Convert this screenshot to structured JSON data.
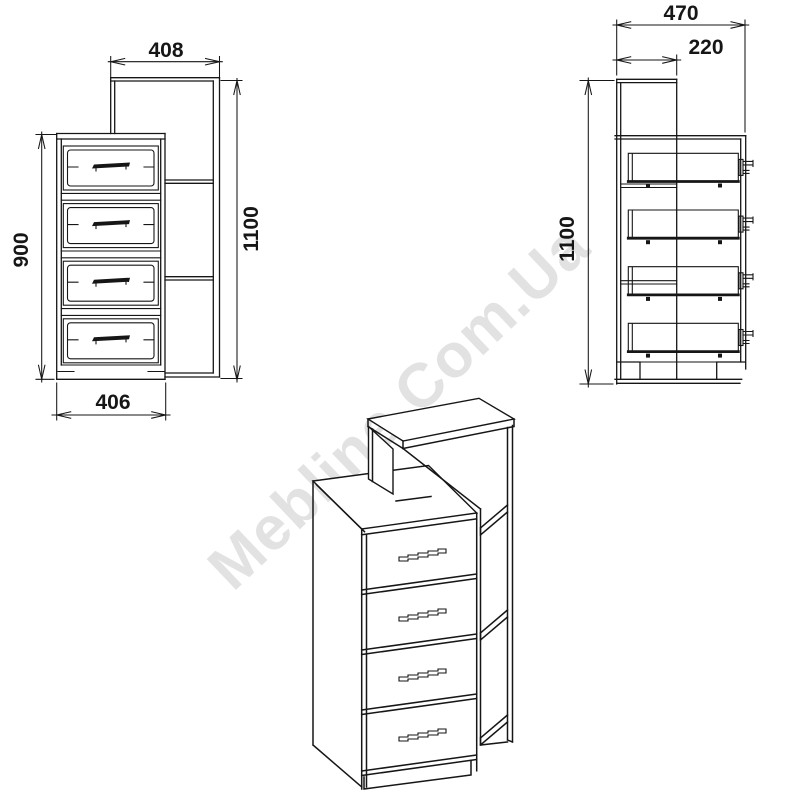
{
  "watermark": {
    "text": "Mebline.Com.Ua",
    "opacity": "0.11"
  },
  "style": {
    "line_color": "#161616",
    "background": "#ffffff"
  },
  "front_view": {
    "label": "front elevation of chest with shelf unit",
    "drawer_count": 4,
    "dims": {
      "shelf_width": "408",
      "total_height": "1100",
      "chest_height": "900",
      "chest_width": "406"
    }
  },
  "side_view": {
    "label": "side elevation",
    "drawer_count": 4,
    "dims": {
      "total_depth": "470",
      "shelf_depth": "220",
      "total_height": "1100"
    }
  },
  "iso_view": {
    "label": "3d isometric view",
    "drawer_count": 4
  }
}
